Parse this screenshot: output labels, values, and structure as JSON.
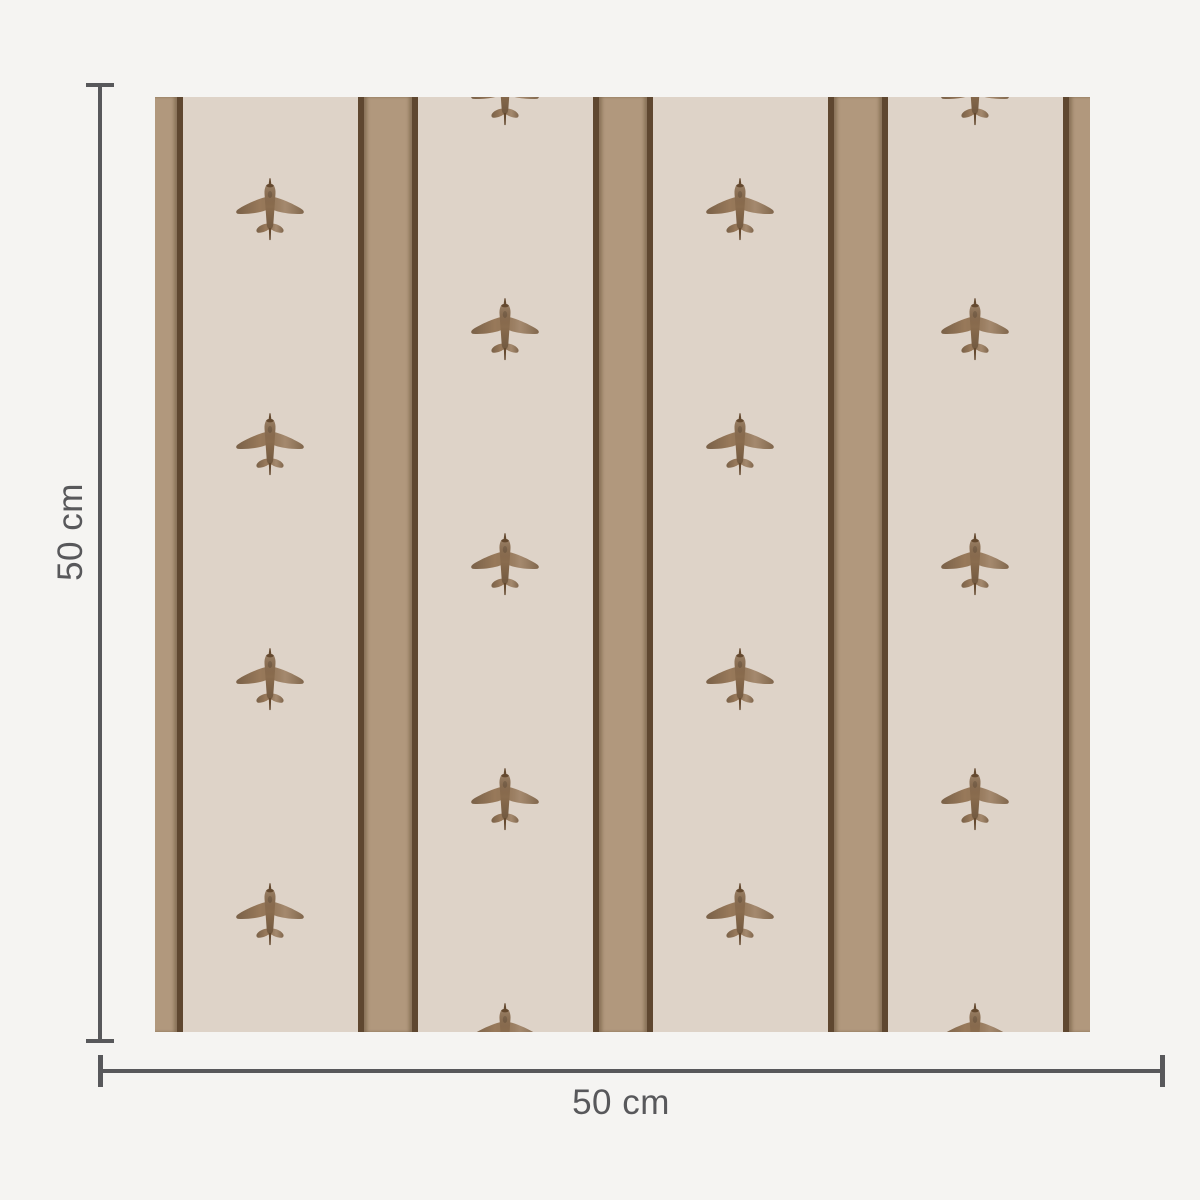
{
  "diagram": {
    "title": "wallpaper swatch dimension diagram",
    "swatch_content": "striped wallpaper with vintage airplane motif"
  },
  "dimensions": {
    "width_label": "50 cm",
    "height_label": "50 cm"
  },
  "colors": {
    "page_bg": "#f5f4f2",
    "swatch_bg": "#ded3c8",
    "stripe_tan": "#b1987d",
    "stripe_edge": "#5f4730",
    "plane_body": "#98795a",
    "plane_fuselage": "#8a6c4e",
    "plane_dark": "#64492f",
    "dim_color": "#58585b"
  },
  "icons": {
    "motif": "airplane-icon (top view, nose up)"
  },
  "swatch": {
    "stripe_centers_px": [
      -2,
      233,
      468,
      703,
      938
    ],
    "stripe_width_px": 60,
    "stripe_edge_px": 6,
    "plane_size_px": {
      "w": 76,
      "h": 66
    },
    "plane_columns": [
      {
        "x": 115,
        "rows": [
          113,
          348,
          583,
          818
        ]
      },
      {
        "x": 350,
        "rows": [
          -2,
          233,
          468,
          703,
          938
        ]
      },
      {
        "x": 585,
        "rows": [
          113,
          348,
          583,
          818
        ]
      },
      {
        "x": 820,
        "rows": [
          -2,
          233,
          468,
          703,
          938
        ]
      }
    ]
  }
}
